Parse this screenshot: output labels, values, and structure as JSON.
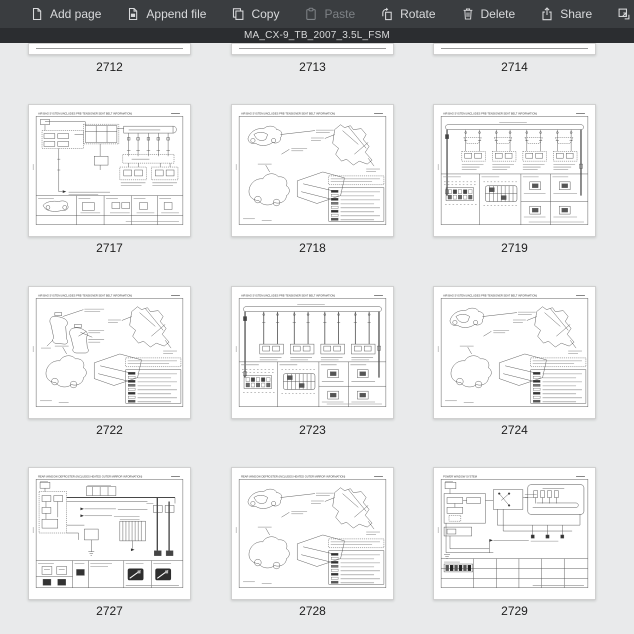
{
  "colors": {
    "toolbar_bg": "#3a3d40",
    "titlebar_bg": "#2b2d30",
    "canvas_bg": "#e9eaeb",
    "page_bg": "#ffffff"
  },
  "toolbar": {
    "items": [
      {
        "label": "Add page",
        "icon": "add-page-icon",
        "enabled": true
      },
      {
        "label": "Append file",
        "icon": "append-file-icon",
        "enabled": true
      },
      {
        "label": "Copy",
        "icon": "copy-icon",
        "enabled": true
      },
      {
        "label": "Paste",
        "icon": "paste-icon",
        "enabled": false
      },
      {
        "label": "Rotate",
        "icon": "rotate-icon",
        "enabled": true
      },
      {
        "label": "Delete",
        "icon": "delete-icon",
        "enabled": true
      },
      {
        "label": "Share",
        "icon": "share-icon",
        "enabled": true
      },
      {
        "label": "Extract",
        "icon": "extract-icon",
        "enabled": true
      }
    ]
  },
  "titlebar": {
    "filename": "MA_CX-9_TB_2007_3.5L_FSM"
  },
  "thumbnails": {
    "partial_row": [
      {
        "number": "2712"
      },
      {
        "number": "2713"
      },
      {
        "number": "2714"
      }
    ],
    "rows": [
      [
        {
          "number": "2717",
          "title": "AIR BAG SYSTEM (INCLUDES PRE-TENSIONER SEAT BELT INFORMATION)",
          "kind": "schematic"
        },
        {
          "number": "2718",
          "title": "AIR BAG SYSTEM (INCLUDES PRE-TENSIONER SEAT BELT INFORMATION)",
          "kind": "harness"
        },
        {
          "number": "2719",
          "title": "AIR BAG SYSTEM (INCLUDES PRE-TENSIONER SEAT BELT INFORMATION)",
          "kind": "connector-bus"
        }
      ],
      [
        {
          "number": "2722",
          "title": "AIR BAG SYSTEM (INCLUDES PRE-TENSIONER SEAT BELT INFORMATION)",
          "kind": "harness-seats"
        },
        {
          "number": "2723",
          "title": "AIR BAG SYSTEM (INCLUDES PRE-TENSIONER SEAT BELT INFORMATION)",
          "kind": "connector-bus-2"
        },
        {
          "number": "2724",
          "title": "AIR BAG SYSTEM (INCLUDES PRE-TENSIONER SEAT BELT INFORMATION)",
          "kind": "harness"
        }
      ],
      [
        {
          "number": "2727",
          "title": "REAR WINDOW DEFROSTER (INCLUDES HEATED OUTER MIRROR INFORMATION)",
          "kind": "defroster"
        },
        {
          "number": "2728",
          "title": "REAR WINDOW DEFROSTER (INCLUDES HEATED OUTER MIRROR INFORMATION)",
          "kind": "harness"
        },
        {
          "number": "2729",
          "title": "POWER WINDOW SYSTEM",
          "kind": "power-window"
        }
      ]
    ]
  }
}
